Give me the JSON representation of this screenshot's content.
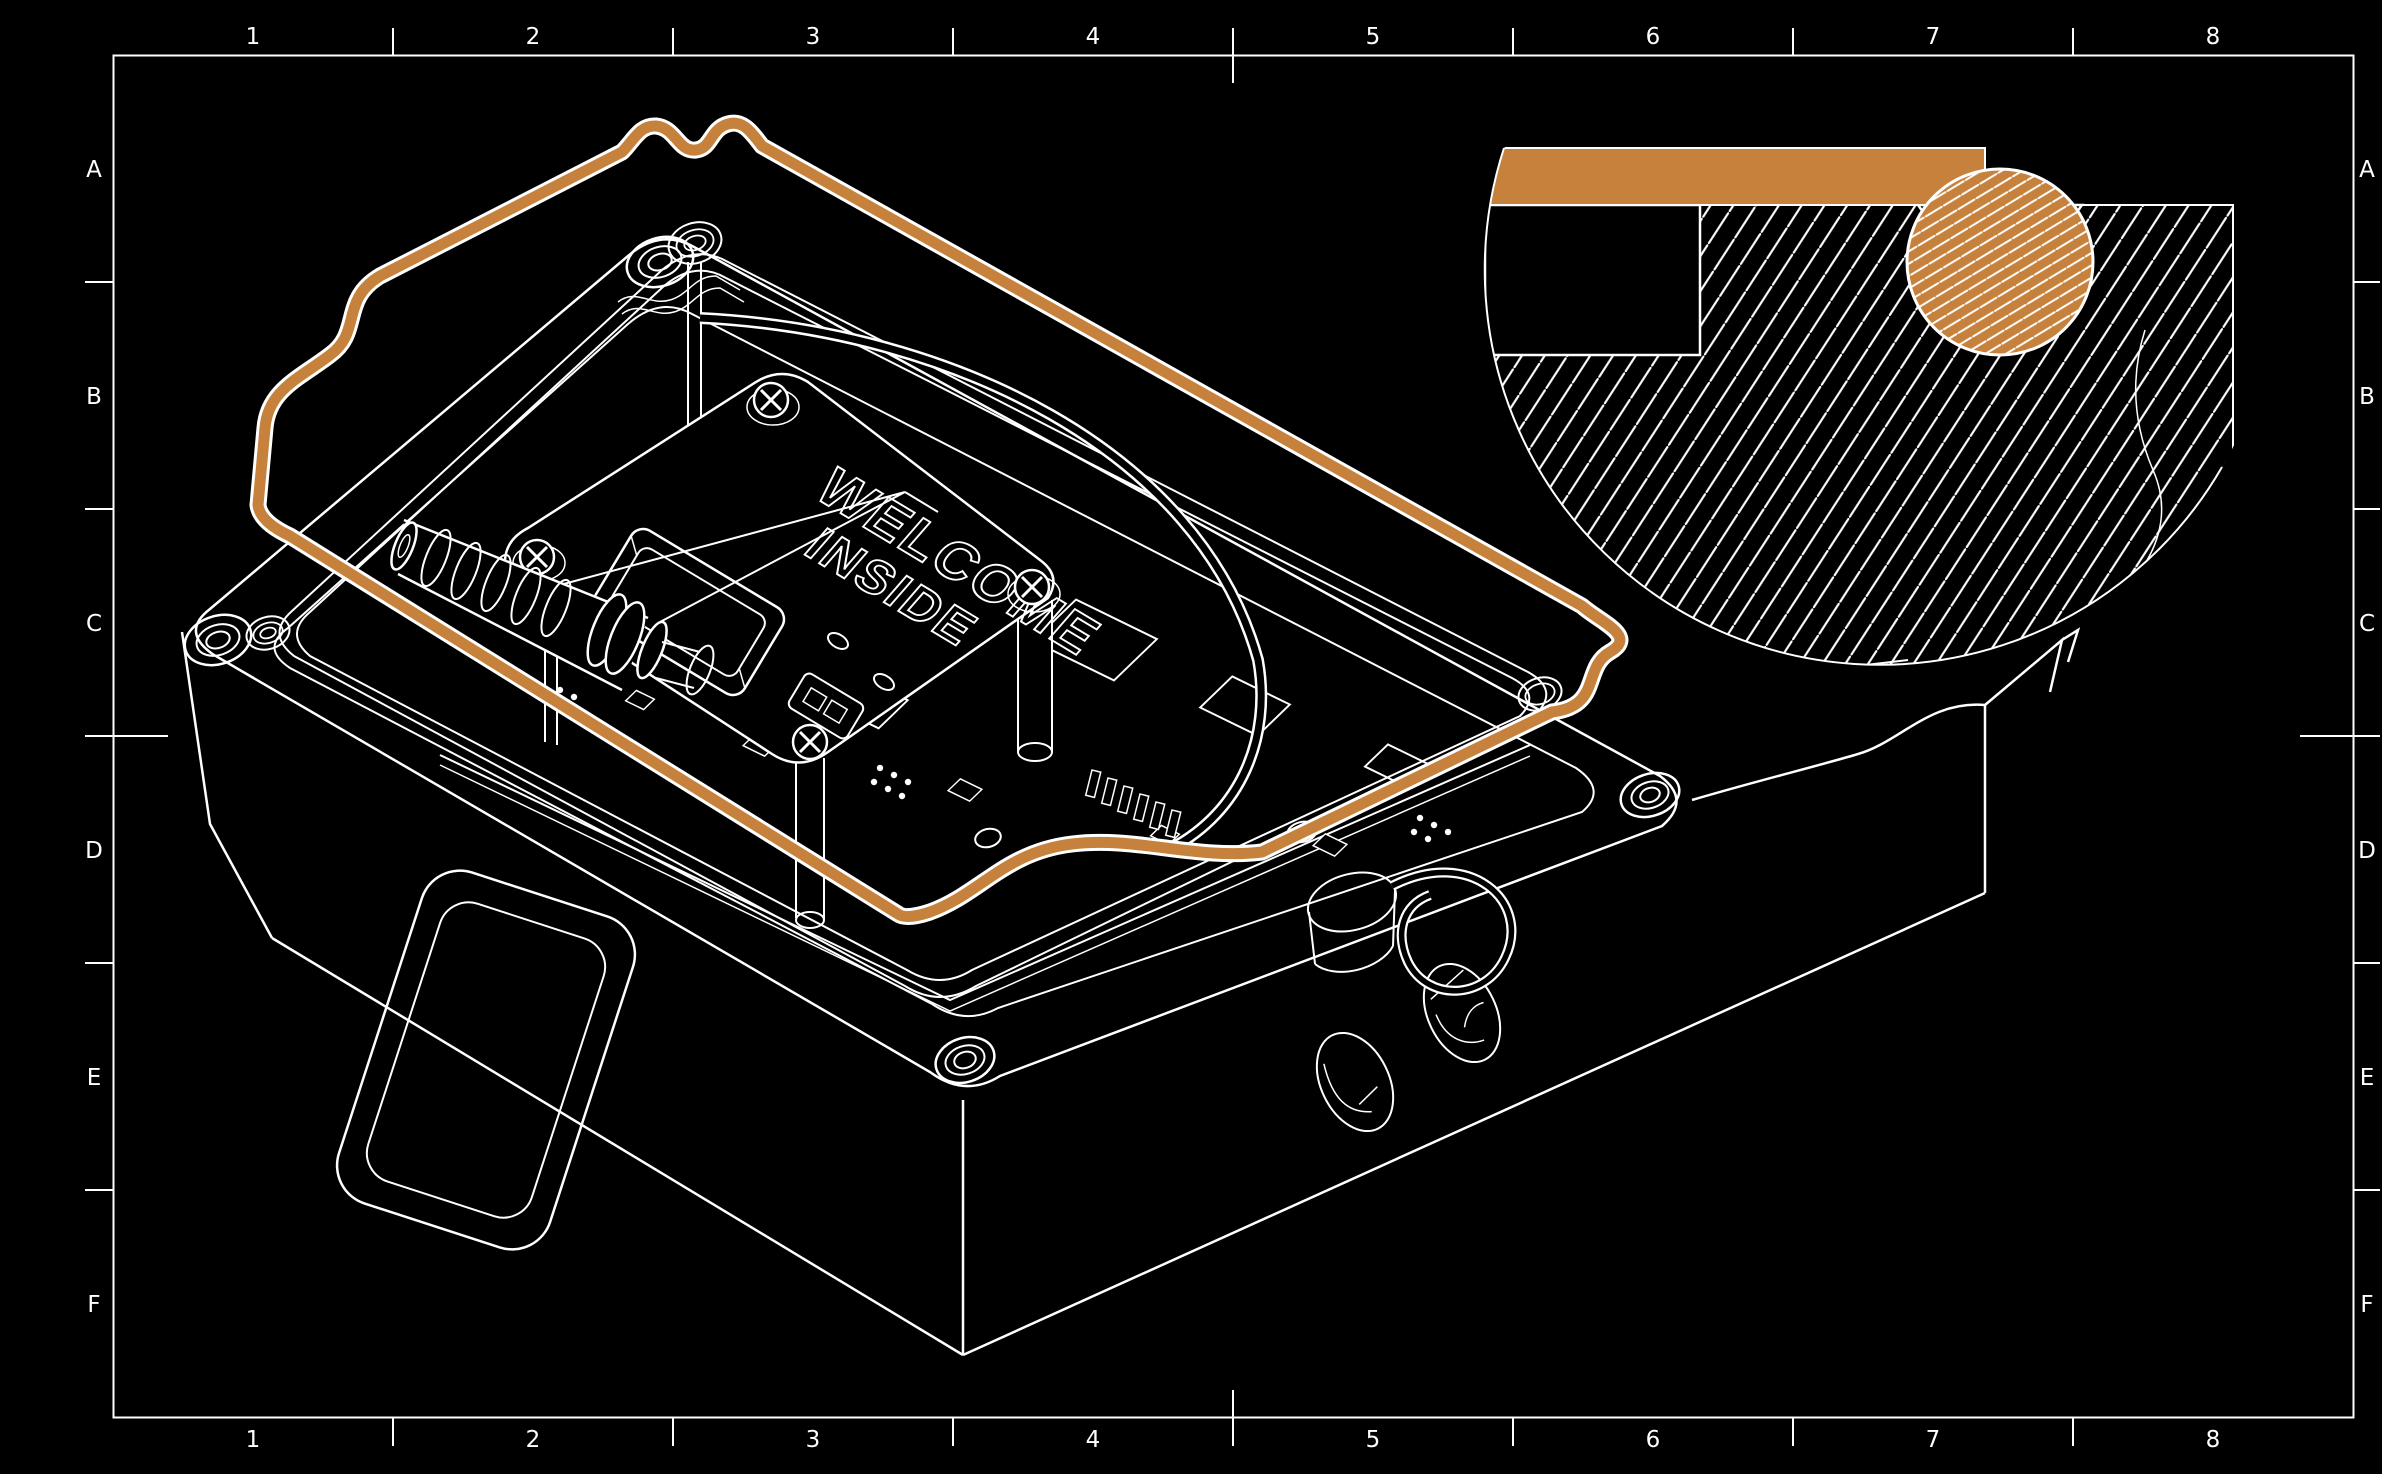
{
  "canvas": {
    "width": 2382,
    "height": 1474,
    "background_color": "#000000",
    "line_color": "#ffffff",
    "accent_color": "#c6823c"
  },
  "frame": {
    "column_labels": [
      "1",
      "2",
      "3",
      "4",
      "5",
      "6",
      "7",
      "8"
    ],
    "row_labels": [
      "A",
      "B",
      "C",
      "D",
      "E",
      "F"
    ]
  },
  "cover_engraving": {
    "line1": "WELCOME",
    "line2": "INSIDE"
  }
}
